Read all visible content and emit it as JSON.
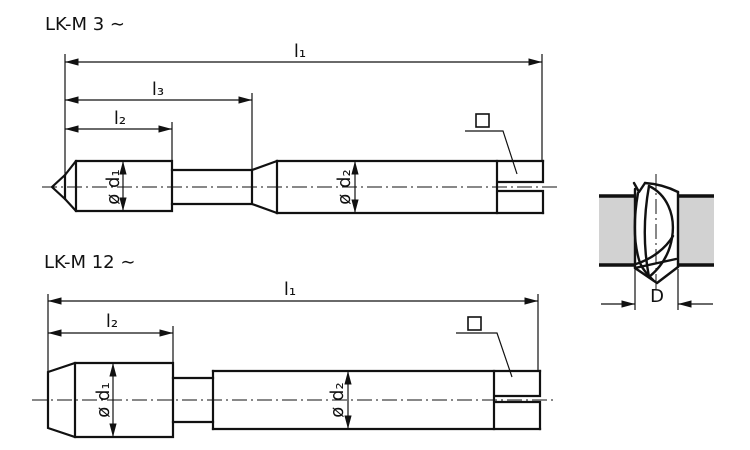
{
  "figure_top": {
    "title": "LK-M 3 ∼",
    "dim_l1": "l₁",
    "dim_l3": "l₃",
    "dim_l2": "l₂",
    "dim_d1": "ø d₁",
    "dim_d2": "ø d₂",
    "square_drive_icon": "□"
  },
  "figure_bottom": {
    "title": "LK-M 12 ∼",
    "dim_l1": "l₁",
    "dim_l2": "l₂",
    "dim_d1": "ø d₁",
    "dim_d2": "ø d₂",
    "square_drive_icon": "□"
  },
  "hole_detail": {
    "dim_D": "D"
  },
  "colors": {
    "line": "#111111",
    "plate_fill": "#d2d2d2",
    "background": "#ffffff"
  }
}
